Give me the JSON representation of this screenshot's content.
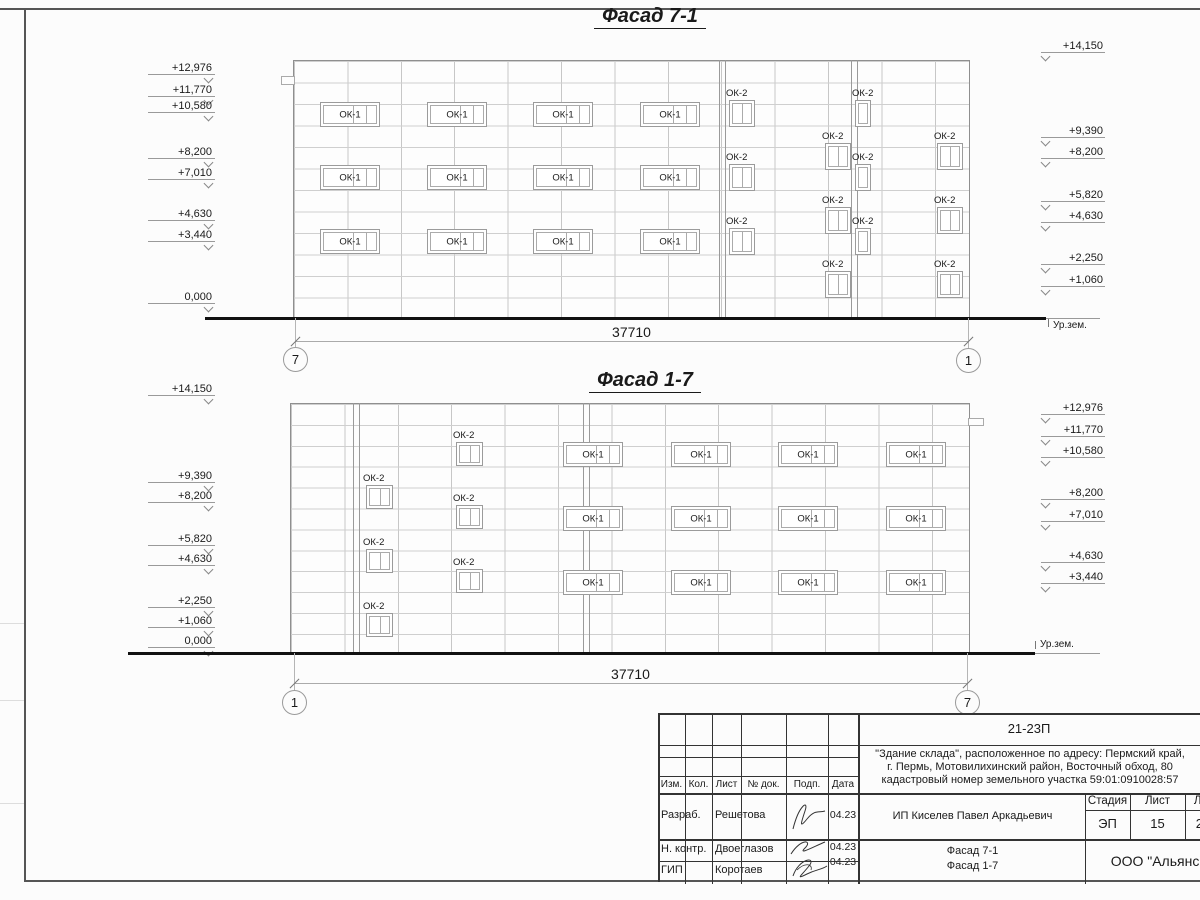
{
  "sheet_frame": {
    "note": "drawing sheet border"
  },
  "facades": [
    {
      "id": "facade-7-1",
      "title": "Фасад 7-1",
      "title_cx": 650,
      "title_y": 5,
      "building": {
        "x": 293,
        "y": 60,
        "w": 675,
        "h": 258,
        "hgap": 21.5,
        "vgap": 53.4
      },
      "extra_vlines": [
        719,
        725,
        851,
        857
      ],
      "steps": [
        {
          "x": 281,
          "y": 76,
          "w": 12,
          "h": 7
        }
      ],
      "windows": [
        {
          "label": "ОК-1",
          "x": 320,
          "y": 102,
          "w": 58,
          "h": 23,
          "panes": 3,
          "above": false
        },
        {
          "label": "ОК-1",
          "x": 427,
          "y": 102,
          "w": 58,
          "h": 23,
          "panes": 3,
          "above": false
        },
        {
          "label": "ОК-1",
          "x": 533,
          "y": 102,
          "w": 58,
          "h": 23,
          "panes": 3,
          "above": false
        },
        {
          "label": "ОК-1",
          "x": 640,
          "y": 102,
          "w": 58,
          "h": 23,
          "panes": 3,
          "above": false
        },
        {
          "label": "ОК-1",
          "x": 320,
          "y": 165,
          "w": 58,
          "h": 23,
          "panes": 3,
          "above": false
        },
        {
          "label": "ОК-1",
          "x": 427,
          "y": 165,
          "w": 58,
          "h": 23,
          "panes": 3,
          "above": false
        },
        {
          "label": "ОК-1",
          "x": 533,
          "y": 165,
          "w": 58,
          "h": 23,
          "panes": 3,
          "above": false
        },
        {
          "label": "ОК-1",
          "x": 640,
          "y": 165,
          "w": 58,
          "h": 23,
          "panes": 3,
          "above": false
        },
        {
          "label": "ОК-1",
          "x": 320,
          "y": 229,
          "w": 58,
          "h": 23,
          "panes": 3,
          "above": false
        },
        {
          "label": "ОК-1",
          "x": 427,
          "y": 229,
          "w": 58,
          "h": 23,
          "panes": 3,
          "above": false
        },
        {
          "label": "ОК-1",
          "x": 533,
          "y": 229,
          "w": 58,
          "h": 23,
          "panes": 3,
          "above": false
        },
        {
          "label": "ОК-1",
          "x": 640,
          "y": 229,
          "w": 58,
          "h": 23,
          "panes": 3,
          "above": false
        },
        {
          "label": "ОК-2",
          "x": 729,
          "y": 100,
          "w": 24,
          "h": 25,
          "panes": 2,
          "above": true
        },
        {
          "label": "ОК-2",
          "x": 729,
          "y": 164,
          "w": 24,
          "h": 25,
          "panes": 2,
          "above": true
        },
        {
          "label": "ОК-2",
          "x": 729,
          "y": 228,
          "w": 24,
          "h": 25,
          "panes": 2,
          "above": true
        },
        {
          "label": "ОК-2",
          "x": 855,
          "y": 100,
          "w": 14,
          "h": 25,
          "panes": 1,
          "above": true
        },
        {
          "label": "ОК-2",
          "x": 855,
          "y": 164,
          "w": 14,
          "h": 25,
          "panes": 1,
          "above": true
        },
        {
          "label": "ОК-2",
          "x": 855,
          "y": 228,
          "w": 14,
          "h": 25,
          "panes": 1,
          "above": true
        },
        {
          "label": "ОК-2",
          "x": 825,
          "y": 143,
          "w": 24,
          "h": 25,
          "panes": 2,
          "above": true
        },
        {
          "label": "ОК-2",
          "x": 825,
          "y": 207,
          "w": 24,
          "h": 25,
          "panes": 2,
          "above": true
        },
        {
          "label": "ОК-2",
          "x": 825,
          "y": 271,
          "w": 24,
          "h": 25,
          "panes": 2,
          "above": true
        },
        {
          "label": "ОК-2",
          "x": 937,
          "y": 143,
          "w": 24,
          "h": 25,
          "panes": 2,
          "above": true
        },
        {
          "label": "ОК-2",
          "x": 937,
          "y": 207,
          "w": 24,
          "h": 25,
          "panes": 2,
          "above": true
        },
        {
          "label": "ОК-2",
          "x": 937,
          "y": 271,
          "w": 24,
          "h": 25,
          "panes": 2,
          "above": true
        }
      ],
      "marks_left": [
        {
          "t": "+12,976",
          "y": 62
        },
        {
          "t": "+11,770",
          "y": 84
        },
        {
          "t": "+10,580",
          "y": 100
        },
        {
          "t": "+8,200",
          "y": 146
        },
        {
          "t": "+7,010",
          "y": 167
        },
        {
          "t": "+4,630",
          "y": 208
        },
        {
          "t": "+3,440",
          "y": 229
        },
        {
          "t": "0,000",
          "y": 291
        }
      ],
      "marks_right": [
        {
          "t": "+14,150",
          "y": 40
        },
        {
          "t": "+9,390",
          "y": 125
        },
        {
          "t": "+8,200",
          "y": 146
        },
        {
          "t": "+5,820",
          "y": 189
        },
        {
          "t": "+4,630",
          "y": 210
        },
        {
          "t": "+2,250",
          "y": 252
        },
        {
          "t": "+1,060",
          "y": 274
        }
      ],
      "ground": {
        "x1": 205,
        "x2": 1046,
        "y": 317,
        "label": "Ур.зем.",
        "label_x": 1053,
        "label_y": 320,
        "thin_x2": 1100
      },
      "dim": {
        "text": "37710",
        "x1": 295,
        "x2": 968,
        "y": 341,
        "text_y": 324
      },
      "axes": [
        {
          "label": "7",
          "cx": 295,
          "cy": 359
        },
        {
          "label": "1",
          "cx": 968,
          "cy": 360
        }
      ]
    },
    {
      "id": "facade-1-7",
      "title": "Фасад 1-7",
      "title_cx": 645,
      "title_y": 369,
      "building": {
        "x": 290,
        "y": 403,
        "w": 678,
        "h": 250,
        "hgap": 20.9,
        "vgap": 53.4
      },
      "extra_vlines": [
        353,
        359,
        583,
        589
      ],
      "steps": [
        {
          "x": 968,
          "y": 418,
          "w": 14,
          "h": 6
        }
      ],
      "windows": [
        {
          "label": "ОК-1",
          "x": 563,
          "y": 442,
          "w": 58,
          "h": 23,
          "panes": 3,
          "above": false
        },
        {
          "label": "ОК-1",
          "x": 671,
          "y": 442,
          "w": 58,
          "h": 23,
          "panes": 3,
          "above": false
        },
        {
          "label": "ОК-1",
          "x": 778,
          "y": 442,
          "w": 58,
          "h": 23,
          "panes": 3,
          "above": false
        },
        {
          "label": "ОК-1",
          "x": 886,
          "y": 442,
          "w": 58,
          "h": 23,
          "panes": 3,
          "above": false
        },
        {
          "label": "ОК-1",
          "x": 563,
          "y": 506,
          "w": 58,
          "h": 23,
          "panes": 3,
          "above": false
        },
        {
          "label": "ОК-1",
          "x": 671,
          "y": 506,
          "w": 58,
          "h": 23,
          "panes": 3,
          "above": false
        },
        {
          "label": "ОК-1",
          "x": 778,
          "y": 506,
          "w": 58,
          "h": 23,
          "panes": 3,
          "above": false
        },
        {
          "label": "ОК-1",
          "x": 886,
          "y": 506,
          "w": 58,
          "h": 23,
          "panes": 3,
          "above": false
        },
        {
          "label": "ОК-1",
          "x": 563,
          "y": 570,
          "w": 58,
          "h": 23,
          "panes": 3,
          "above": false
        },
        {
          "label": "ОК-1",
          "x": 671,
          "y": 570,
          "w": 58,
          "h": 23,
          "panes": 3,
          "above": false
        },
        {
          "label": "ОК-1",
          "x": 778,
          "y": 570,
          "w": 58,
          "h": 23,
          "panes": 3,
          "above": false
        },
        {
          "label": "ОК-1",
          "x": 886,
          "y": 570,
          "w": 58,
          "h": 23,
          "panes": 3,
          "above": false
        },
        {
          "label": "ОК-2",
          "x": 456,
          "y": 442,
          "w": 25,
          "h": 22,
          "panes": 2,
          "above": true
        },
        {
          "label": "ОК-2",
          "x": 456,
          "y": 505,
          "w": 25,
          "h": 22,
          "panes": 2,
          "above": true
        },
        {
          "label": "ОК-2",
          "x": 456,
          "y": 569,
          "w": 25,
          "h": 22,
          "panes": 2,
          "above": true
        },
        {
          "label": "ОК-2",
          "x": 366,
          "y": 485,
          "w": 25,
          "h": 22,
          "panes": 2,
          "above": true
        },
        {
          "label": "ОК-2",
          "x": 366,
          "y": 549,
          "w": 25,
          "h": 22,
          "panes": 2,
          "above": true
        },
        {
          "label": "ОК-2",
          "x": 366,
          "y": 613,
          "w": 25,
          "h": 22,
          "panes": 2,
          "above": true
        }
      ],
      "marks_left": [
        {
          "t": "+14,150",
          "y": 383
        },
        {
          "t": "+9,390",
          "y": 470
        },
        {
          "t": "+8,200",
          "y": 490
        },
        {
          "t": "+5,820",
          "y": 533
        },
        {
          "t": "+4,630",
          "y": 553
        },
        {
          "t": "+2,250",
          "y": 595
        },
        {
          "t": "+1,060",
          "y": 615
        },
        {
          "t": "0,000",
          "y": 635
        }
      ],
      "marks_right": [
        {
          "t": "+12,976",
          "y": 402
        },
        {
          "t": "+11,770",
          "y": 424
        },
        {
          "t": "+10,580",
          "y": 445
        },
        {
          "t": "+8,200",
          "y": 487
        },
        {
          "t": "+7,010",
          "y": 509
        },
        {
          "t": "+4,630",
          "y": 550
        },
        {
          "t": "+3,440",
          "y": 571
        }
      ],
      "ground": {
        "x1": 128,
        "x2": 1035,
        "y": 652,
        "label": "Ур.зем.",
        "label_x": 1040,
        "label_y": 639,
        "thin_x2": 1100
      },
      "dim": {
        "text": "37710",
        "x1": 294,
        "x2": 967,
        "y": 683,
        "text_y": 666
      },
      "axes": [
        {
          "label": "1",
          "cx": 294,
          "cy": 702
        },
        {
          "label": "7",
          "cx": 967,
          "cy": 702
        }
      ]
    }
  ],
  "titleblock": {
    "code": "21-23П",
    "description_lines": [
      "\"Здание склада\", расположенное по адресу: Пермский край,",
      "г. Пермь, Мотовилихинский район, Восточный обход, 80",
      "кадастровый номер земельного участка 59:01:0910028:57"
    ],
    "client": "ИП Киселев Павел Аркадьевич",
    "drawing_titles": [
      "Фасад 7-1",
      "Фасад 1-7"
    ],
    "company": "ООО \"Альянс\"",
    "stage": {
      "label": "Стадия",
      "value": "ЭП"
    },
    "sheet": {
      "label": "Лист",
      "value": "15"
    },
    "sheets": {
      "label": "Листов",
      "value": "23"
    },
    "header_cols": [
      "Изм.",
      "Кол.",
      "Лист",
      "№ док.",
      "Подп.",
      "Дата"
    ],
    "signature_rows": [
      {
        "role": "Разраб.",
        "name": "Решетова",
        "date": "04.23"
      },
      {
        "role": "Н. контр.",
        "name": "Двоеглазов",
        "date": "04.23"
      },
      {
        "role": "ГИП",
        "name": "Коротаев",
        "date": "04.23"
      }
    ]
  }
}
